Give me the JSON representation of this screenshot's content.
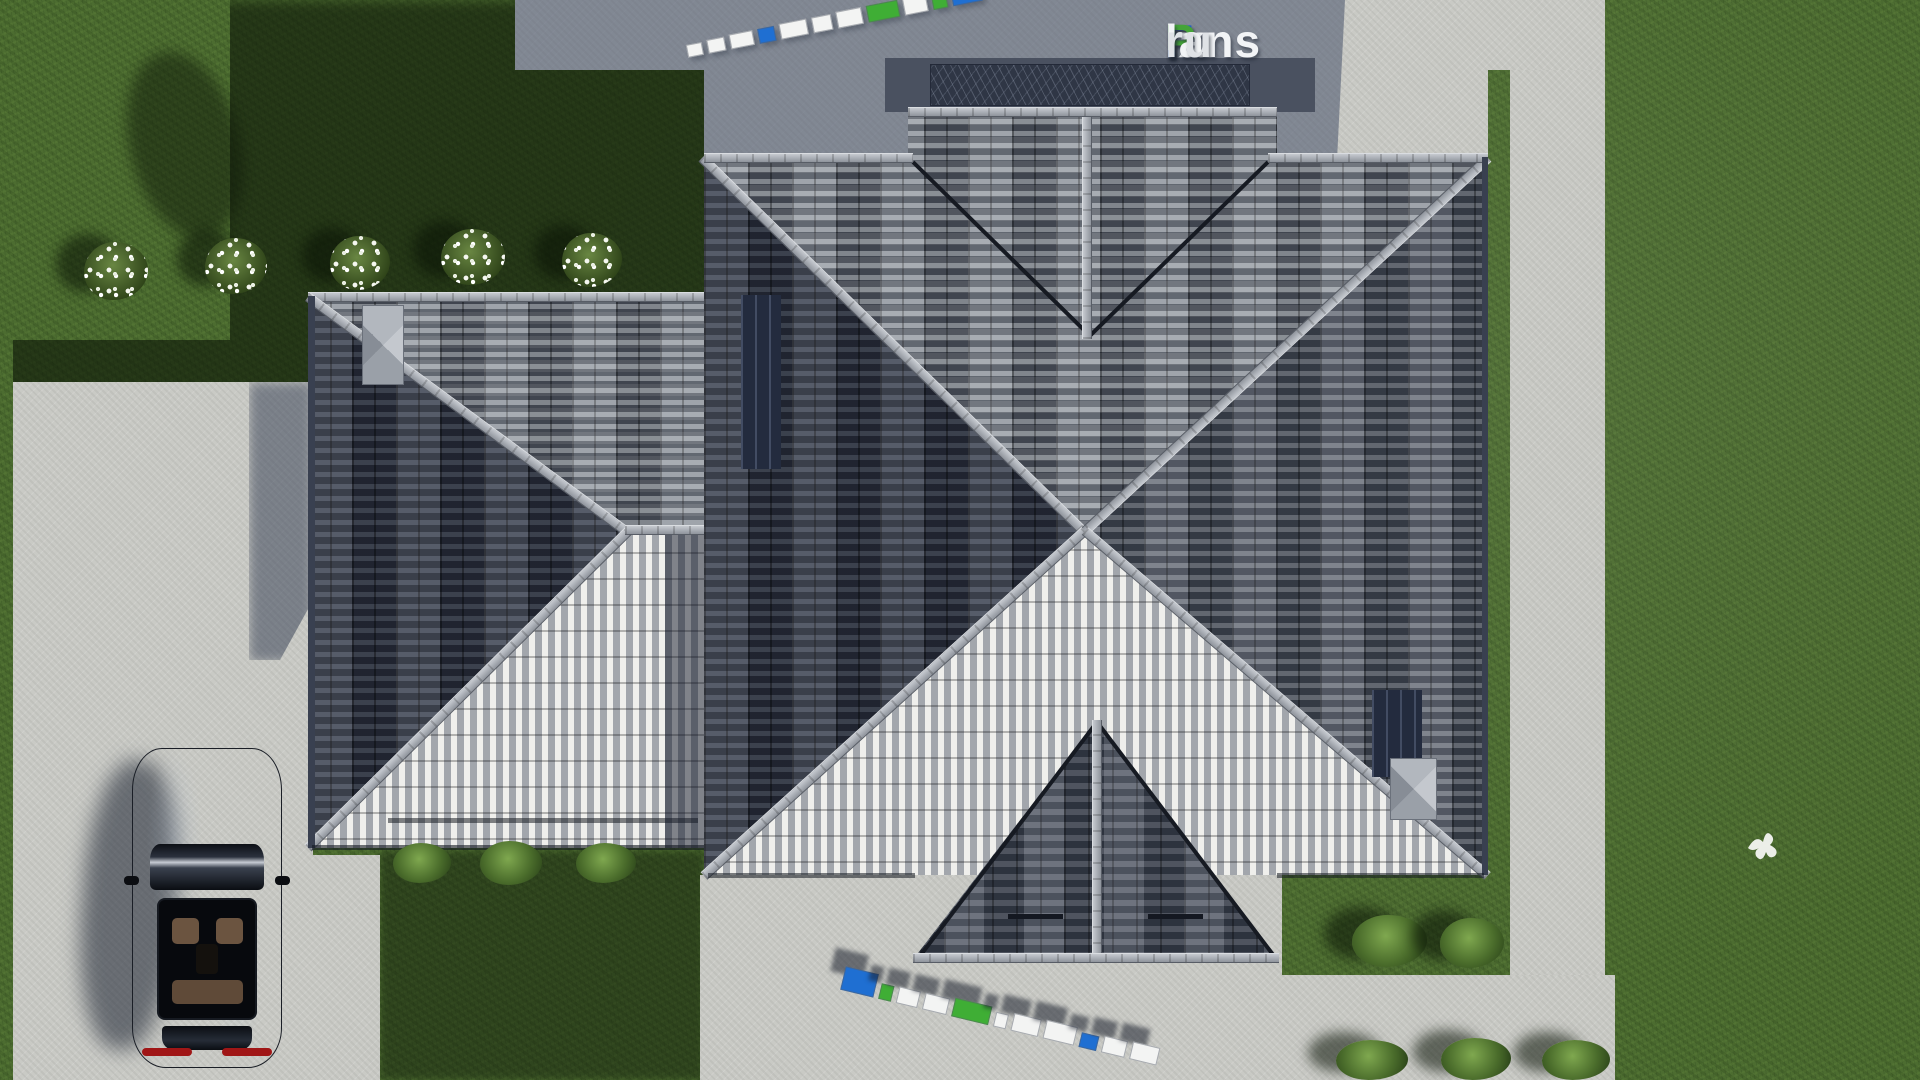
{
  "brand": {
    "name": "FixPlans.ru",
    "logo": [
      {
        "t": "F",
        "c": "#2563c6"
      },
      {
        "t": "ix",
        "c": "#f2f4f6"
      },
      {
        "t": "P",
        "c": "#44a438"
      },
      {
        "t": "lans",
        "c": "#f2f4f6"
      },
      {
        "t": ".",
        "c": "#2563c6"
      },
      {
        "t": "ru",
        "c": "#dfe2e6"
      }
    ]
  },
  "watermarks": {
    "top": {
      "blocks": [
        {
          "c": "#f3f4f3",
          "w": 16,
          "h": 13
        },
        {
          "c": "#f3f4f3",
          "w": 18,
          "h": 14
        },
        {
          "c": "#f3f4f3",
          "w": 24,
          "h": 15
        },
        {
          "c": "#1f6fd2",
          "w": 17,
          "h": 15
        },
        {
          "c": "#f3f4f3",
          "w": 28,
          "h": 16
        },
        {
          "c": "#f3f4f3",
          "w": 20,
          "h": 16
        },
        {
          "c": "#f3f4f3",
          "w": 26,
          "h": 17
        },
        {
          "c": "#3fae35",
          "w": 32,
          "h": 17
        },
        {
          "c": "#f3f4f3",
          "w": 24,
          "h": 18
        },
        {
          "c": "#3fae35",
          "w": 15,
          "h": 18
        },
        {
          "c": "#1f6fd2",
          "w": 30,
          "h": 24
        }
      ]
    },
    "bottom": {
      "blocks": [
        {
          "c": "#1f6fd2",
          "w": 34,
          "h": 24
        },
        {
          "c": "#3fae35",
          "w": 13,
          "h": 16
        },
        {
          "c": "#f3f4f3",
          "w": 22,
          "h": 17
        },
        {
          "c": "#f3f4f3",
          "w": 25,
          "h": 17
        },
        {
          "c": "#3fae35",
          "w": 38,
          "h": 19
        },
        {
          "c": "#f3f4f3",
          "w": 13,
          "h": 15
        },
        {
          "c": "#f3f4f3",
          "w": 28,
          "h": 18
        },
        {
          "c": "#f3f4f3",
          "w": 32,
          "h": 19
        },
        {
          "c": "#1f6fd2",
          "w": 18,
          "h": 15
        },
        {
          "c": "#f3f4f3",
          "w": 24,
          "h": 17
        },
        {
          "c": "#f3f4f3",
          "w": 28,
          "h": 18
        }
      ]
    }
  },
  "palette": {
    "lawn": "#4c6c30",
    "lawn_shadow": "#1c2c12",
    "pavement": "#c9cac5",
    "pavement_shadow": "#8c93a0",
    "roof_tile_dark": "#474d58",
    "roof_tile_light": "#8e949c",
    "roof_tile_bright": "#efefec",
    "ridge_cap": "#b6bac1",
    "terrace": "#3b4251",
    "car": "#07090d",
    "accent_blue": "#2563c6",
    "accent_green": "#44a438"
  }
}
